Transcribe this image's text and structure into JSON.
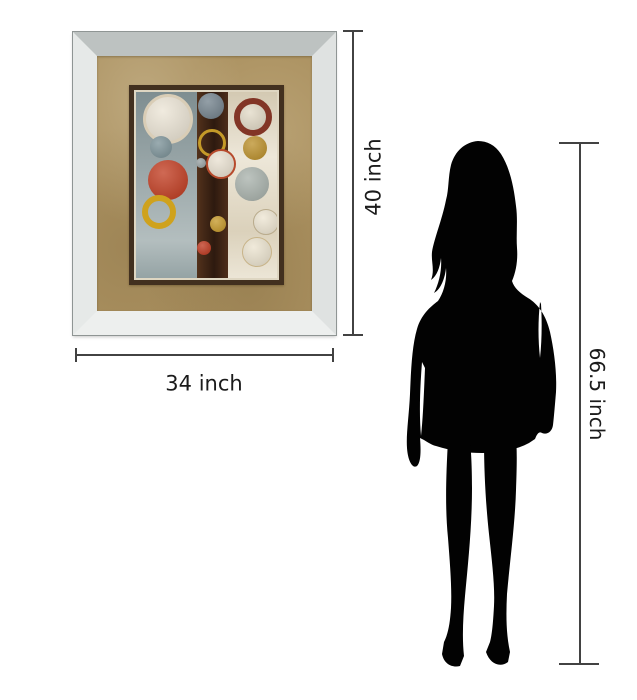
{
  "canvas": {
    "width": 637,
    "height": 700,
    "background": "#ffffff"
  },
  "labels": {
    "frame_height": "40 inch",
    "frame_width": "34 inch",
    "person_height": "66.5 inch"
  },
  "styles": {
    "dimension_line_color": "#424242",
    "label_color": "#1b1b1b",
    "silhouette_color": "#020202",
    "mat_color": "#ab9160",
    "art_border_color": "#42301f",
    "frame": {
      "top": "#bdc2c1",
      "left": "#e6e9e8",
      "right": "#dfe2e1",
      "bottom": "#edefee"
    }
  },
  "artwork": {
    "panels": [
      {
        "name": "panel-left",
        "color": "#919fa1"
      },
      {
        "name": "panel-middle",
        "color": "#3f2415"
      },
      {
        "name": "panel-right",
        "color": "#e7dfcc"
      }
    ],
    "circles": [
      {
        "name": "large-cream-circle",
        "cx": 32,
        "cy": 27,
        "r": 25,
        "fill": "#ece5d6",
        "ring": "#d9cdb6",
        "ringw": 3
      },
      {
        "name": "slate-circle",
        "cx": 25,
        "cy": 55,
        "r": 11,
        "fill": "#7e949a"
      },
      {
        "name": "red-circle",
        "cx": 32,
        "cy": 88,
        "r": 20,
        "fill": "#c23f24"
      },
      {
        "name": "yellow-ring",
        "cx": 23,
        "cy": 120,
        "r": 17,
        "fill": "none",
        "ring": "#cfa21d",
        "ringw": 6
      },
      {
        "name": "slate-circle-top",
        "cx": 75,
        "cy": 14,
        "r": 13,
        "fill": "#75848e"
      },
      {
        "name": "gold-ring",
        "cx": 76,
        "cy": 51,
        "r": 14,
        "fill": "none",
        "ring": "#c49a28",
        "ringw": 3
      },
      {
        "name": "tiny-gray-circle",
        "cx": 65,
        "cy": 71,
        "r": 5,
        "fill": "#9aa3a4"
      },
      {
        "name": "cream-red-ring-circle",
        "cx": 85,
        "cy": 72,
        "r": 15,
        "fill": "#eae2d2",
        "ring": "#b74a2c",
        "ringw": 2
      },
      {
        "name": "gold-circle-small",
        "cx": 82,
        "cy": 132,
        "r": 8,
        "fill": "#c69a2c"
      },
      {
        "name": "red-circle-small",
        "cx": 68,
        "cy": 156,
        "r": 7,
        "fill": "#bf3b22"
      },
      {
        "name": "maroon-ring",
        "cx": 117,
        "cy": 25,
        "r": 19,
        "fill": "#e3dbc8",
        "ring": "#823526",
        "ringw": 6
      },
      {
        "name": "gold-circle",
        "cx": 119,
        "cy": 56,
        "r": 12,
        "fill": "#bd922e"
      },
      {
        "name": "steel-circle",
        "cx": 116,
        "cy": 92,
        "r": 17,
        "fill": "#aab3ad"
      },
      {
        "name": "outline-circle-upper",
        "cx": 130,
        "cy": 130,
        "r": 13,
        "fill": "#eee6d3",
        "ring": "#b9ab8c",
        "ringw": 1
      },
      {
        "name": "outline-circle-lower",
        "cx": 121,
        "cy": 160,
        "r": 15,
        "fill": "#ece4d0",
        "ring": "#c8b489",
        "ringw": 1
      }
    ]
  }
}
